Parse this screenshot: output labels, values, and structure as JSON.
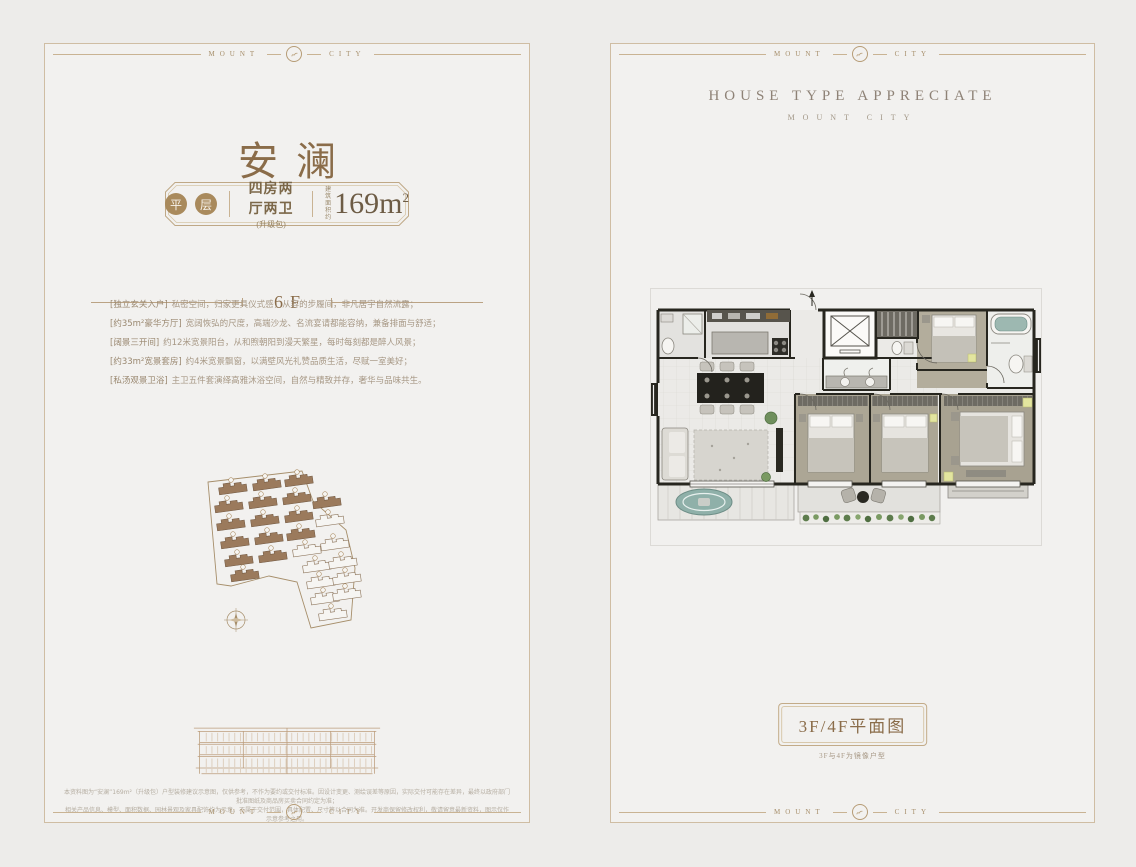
{
  "frame": {
    "brand_left": "MOUNT",
    "brand_right": "CITY"
  },
  "left_panel": {
    "title": "安澜",
    "badge": {
      "tag_char_1": "平",
      "tag_char_2": "层",
      "layout": "四房两厅两卫",
      "layout_note": "(升级包)",
      "area_label_1": "建筑",
      "area_label_2": "面积约",
      "area_value": "169m",
      "area_sup": "2"
    },
    "floor_label": "6F",
    "features": [
      {
        "label": "[独立玄关入户]",
        "text": "私密空间，归家更具仪式感，从容的步履间，非凡居宇自然流露；"
      },
      {
        "label": "[约35m²豪华方厅]",
        "text": "宽阔恢弘的尺度，高端沙龙、名流宴请都能容纳，兼备排面与舒适；"
      },
      {
        "label": "[阔景三开间]",
        "text": "约12米宽景阳台，从和煦朝阳到漫天繁星，每时每刻都是醉人风景；"
      },
      {
        "label": "[约33m²宽景套房]",
        "text": "约4米宽景飘窗，以满壁风光礼赞品质生活，尽赋一室美好；"
      },
      {
        "label": "[私汤观景卫浴]",
        "text": "主卫五件套演绎高雅沐浴空间，自然与精致并存，奢华与品味共生。"
      }
    ],
    "disclaimer_1": "本资料图为“安澜”169m²（升级包）户型装修建议示意图，仅供参考，不作为要约或交付标准。因设计变更、测绘误差等原因，实际交付可能存在差异，最终以政府部门批准图纸及商品房买卖合同约定为准；",
    "disclaimer_2": "相关产品信息、模型、面积数据、园林景观及家具配饰均为示意，不属于交付范围，具体配置、尺寸等以合同为准。开发商保留修改权利，敬请留意最新资料，图示仅作示意参考之用。"
  },
  "right_panel": {
    "header_title": "HOUSE TYPE APPRECIATE",
    "header_subtitle": "MOUNT CITY",
    "plan_label": "3F/4F平面图",
    "plan_note": "3F与4F为镜像户型"
  },
  "colors": {
    "accent": "#8a6c49",
    "frame_line": "#c9b393",
    "muted_text": "#a79885"
  }
}
